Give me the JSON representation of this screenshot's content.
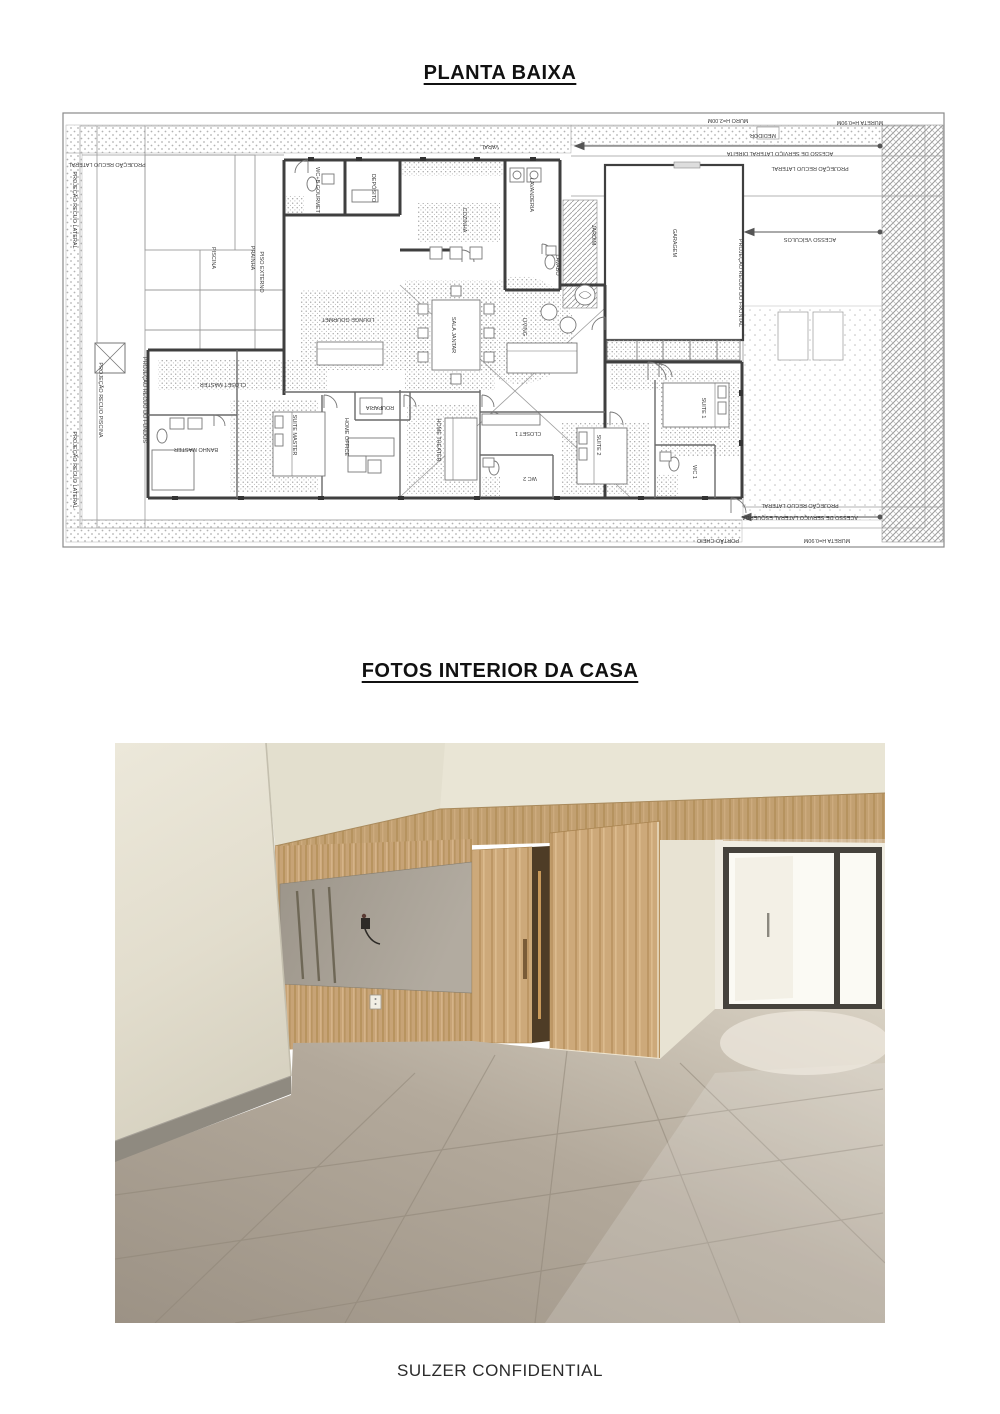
{
  "document": {
    "title_plan": "PLANTA BAIXA",
    "title_photos": "FOTOS INTERIOR DA CASA",
    "footer": "SULZER CONFIDENTIAL"
  },
  "palette": {
    "wood": "#c5a172",
    "wood_light": "#d2ac7c",
    "floor_tile": "#a99f92",
    "wall_cream": "#e8e4d5",
    "plan_wall": "#3f3f3f"
  },
  "floorplan": {
    "labels": [
      {
        "t": "PROJEÇÃO RECUO LATERAL",
        "x": 45,
        "y": 51,
        "o": "h"
      },
      {
        "t": "MURO H=2.00M",
        "x": 666,
        "y": 7,
        "o": "h"
      },
      {
        "t": "MEDIDOR",
        "x": 701,
        "y": 22,
        "o": "h"
      },
      {
        "t": "MURETA H=0.90M",
        "x": 798,
        "y": 9,
        "o": "h"
      },
      {
        "t": "ACESSO DE SERVIÇO LATERAL DIREITA",
        "x": 718,
        "y": 40,
        "o": "h"
      },
      {
        "t": "PROJEÇÃO RECUO LATERAL",
        "x": 748,
        "y": 55,
        "o": "h"
      },
      {
        "t": "ACESSO VEÍCULOS",
        "x": 748,
        "y": 126,
        "o": "h"
      },
      {
        "t": "PROJEÇÃO RECUO DO FRONTAL",
        "x": 677,
        "y": 171,
        "o": "v"
      },
      {
        "t": "PROJEÇÃO RECUO LATERAL",
        "x": 11,
        "y": 98,
        "o": "v"
      },
      {
        "t": "PROJEÇÃO RECUO PISCINA",
        "x": 37,
        "y": 288,
        "o": "v"
      },
      {
        "t": "PROJEÇÃO RECUO DO FUNDOS",
        "x": 81,
        "y": 288,
        "o": "v"
      },
      {
        "t": "PROJEÇÃO RECUO LATERAL",
        "x": 11,
        "y": 358,
        "o": "v"
      },
      {
        "t": "PROJEÇÃO RECUO LATERAL",
        "x": 738,
        "y": 392,
        "o": "h"
      },
      {
        "t": "ACESSO DE SERVIÇO LATERAL ESQUERDA",
        "x": 738,
        "y": 404,
        "o": "h"
      },
      {
        "t": "MURETA H=0.90M",
        "x": 765,
        "y": 427,
        "o": "h"
      },
      {
        "t": "PORTÃO CHEIO",
        "x": 656,
        "y": 427,
        "o": "h"
      },
      {
        "t": "VARAL",
        "x": 428,
        "y": 33,
        "o": "h"
      },
      {
        "t": "PISCINA",
        "x": 150,
        "y": 146,
        "o": "v"
      },
      {
        "t": "PRAINHA",
        "x": 189,
        "y": 146,
        "o": "v"
      },
      {
        "t": "PISO EXTERNO",
        "x": 198,
        "y": 160,
        "o": "v"
      },
      {
        "t": "WC+B GOURMET",
        "x": 254,
        "y": 78,
        "o": "v"
      },
      {
        "t": "DEPÓSITO",
        "x": 310,
        "y": 76,
        "o": "v"
      },
      {
        "t": "COZINHA",
        "x": 401,
        "y": 108,
        "o": "v"
      },
      {
        "t": "LAVANDERIA",
        "x": 468,
        "y": 83,
        "o": "v"
      },
      {
        "t": "LAVABO",
        "x": 494,
        "y": 153,
        "o": "v"
      },
      {
        "t": "JARDIM",
        "x": 530,
        "y": 123,
        "o": "v"
      },
      {
        "t": "LOUNGE GOURMET",
        "x": 286,
        "y": 206,
        "o": "h"
      },
      {
        "t": "SALA JANTAR",
        "x": 390,
        "y": 223,
        "o": "v"
      },
      {
        "t": "LIVING",
        "x": 461,
        "y": 215,
        "o": "v"
      },
      {
        "t": "GARAGEM",
        "x": 611,
        "y": 131,
        "o": "v"
      },
      {
        "t": "CLOSET MASTER",
        "x": 161,
        "y": 271,
        "o": "h"
      },
      {
        "t": "BANHO MASTER",
        "x": 134,
        "y": 336,
        "o": "h"
      },
      {
        "t": "SUITE MASTER",
        "x": 231,
        "y": 323,
        "o": "v"
      },
      {
        "t": "HOME OFFICE",
        "x": 283,
        "y": 325,
        "o": "v"
      },
      {
        "t": "ROUPARIA",
        "x": 318,
        "y": 294,
        "o": "h"
      },
      {
        "t": "HOME THEATER",
        "x": 375,
        "y": 328,
        "o": "v"
      },
      {
        "t": "CLOSET 1",
        "x": 466,
        "y": 320,
        "o": "h"
      },
      {
        "t": "WC 2",
        "x": 468,
        "y": 365,
        "o": "h"
      },
      {
        "t": "SUITE 2",
        "x": 535,
        "y": 333,
        "o": "v"
      },
      {
        "t": "WC 1",
        "x": 631,
        "y": 360,
        "o": "v"
      },
      {
        "t": "SUITE 1",
        "x": 640,
        "y": 296,
        "o": "v"
      }
    ]
  }
}
